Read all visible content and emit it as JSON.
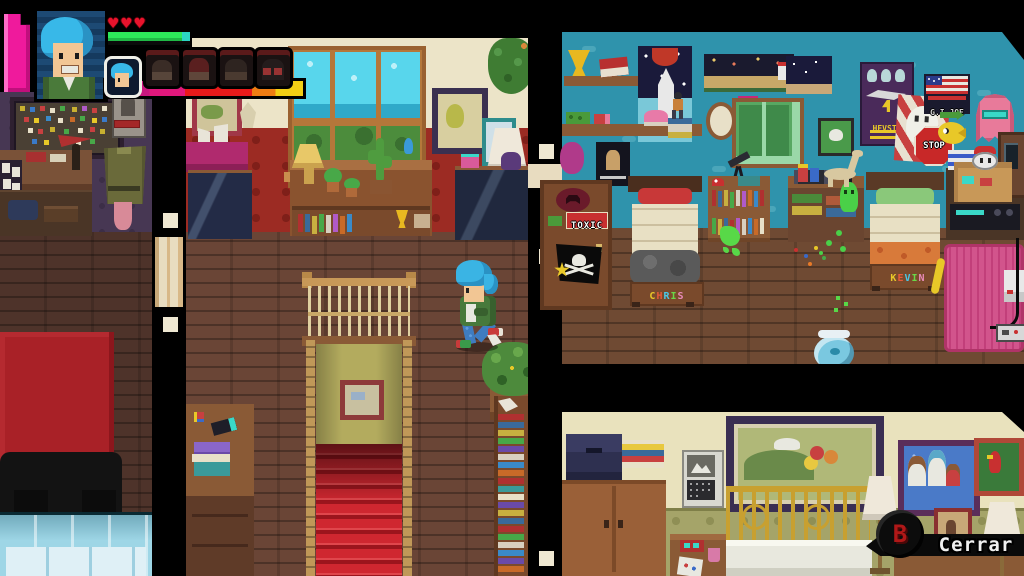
{
  "hud": {
    "hearts": {
      "count": 3,
      "color": "#e8132c"
    },
    "health": {
      "percent": 100,
      "bar_color": "#2de85a",
      "cap_color": "#2cd4c4"
    },
    "portrait_character": "chris-blue-hair",
    "party": [
      {
        "id": "chris",
        "selected": true
      },
      {
        "id": "member-2",
        "selected": false
      },
      {
        "id": "member-3",
        "selected": false
      },
      {
        "id": "member-4",
        "selected": false
      },
      {
        "id": "member-5",
        "selected": false
      }
    ]
  },
  "prompt": {
    "button": "B",
    "label": "Cerrar",
    "button_color": "#b01818"
  },
  "kids_room": {
    "bed_left_label": "CHRIS",
    "bed_right_label": "KEVIN",
    "door_sign": "TOXIC",
    "posters": {
      "stop": "STOP",
      "alien": "HEVSTA",
      "flag": "G.I.JOE"
    }
  },
  "palette": {
    "kids_wall": "#2f93ac",
    "center_upper_wall": "#ece4c8",
    "center_red_wallpaper": "#9c2b23",
    "study_wall": "#473753",
    "parents_wall": "#e9e2bd",
    "wood_floor": "#6a4536",
    "stairs_red": "#c32127",
    "rug_red": "#a92127",
    "rug_pink": "#d2548c",
    "rainbow_letters": [
      "#e8c828",
      "#e85a3a",
      "#4ac8e8",
      "#6ad848",
      "#e88ab8"
    ]
  }
}
